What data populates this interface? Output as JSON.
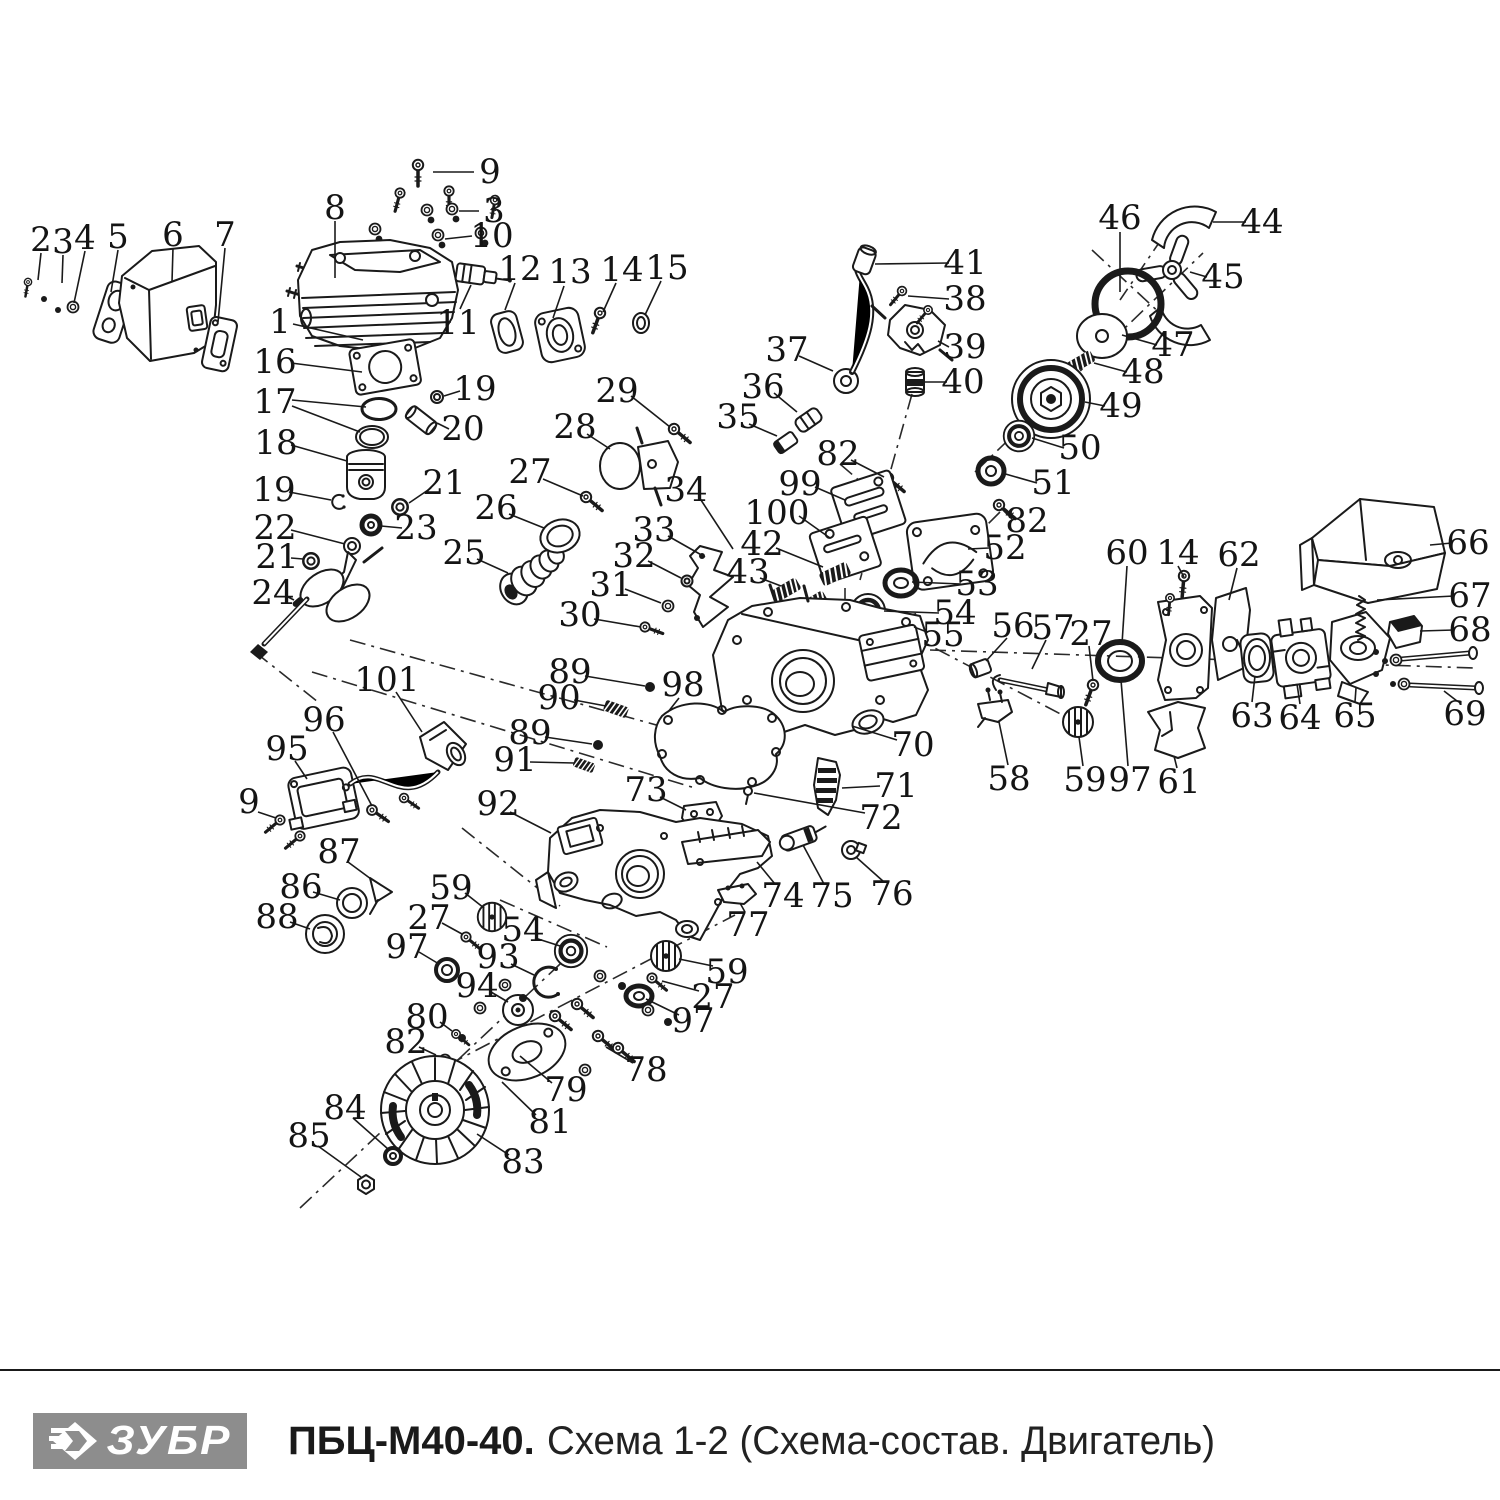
{
  "footer": {
    "brand": "ЗУБР",
    "model": "ПБЦ-М40-40.",
    "subtitle": "Схема 1-2 (Схема-состав. Двигатель)"
  },
  "colors": {
    "line": "#1a1a1a",
    "logo_bg": "#8d8d8d",
    "label": "#141414"
  },
  "labels": [
    {
      "n": "2",
      "x": 41,
      "y": 240,
      "lead": [
        [
          41,
          253,
          38,
          280
        ]
      ]
    },
    {
      "n": "3",
      "x": 63,
      "y": 242,
      "lead": [
        [
          63,
          255,
          62,
          283
        ]
      ]
    },
    {
      "n": "4",
      "x": 85,
      "y": 238,
      "lead": [
        [
          85,
          251,
          74,
          303
        ]
      ]
    },
    {
      "n": "5",
      "x": 118,
      "y": 237,
      "lead": [
        [
          118,
          250,
          111,
          292
        ]
      ]
    },
    {
      "n": "6",
      "x": 173,
      "y": 235,
      "lead": [
        [
          173,
          248,
          172,
          282
        ]
      ]
    },
    {
      "n": "7",
      "x": 225,
      "y": 235,
      "lead": [
        [
          225,
          248,
          218,
          322
        ]
      ]
    },
    {
      "n": "9",
      "x": 490,
      "y": 172,
      "lead": [
        [
          474,
          172,
          433,
          172
        ]
      ]
    },
    {
      "n": "8",
      "x": 335,
      "y": 208,
      "lead": [
        [
          335,
          221,
          335,
          278
        ]
      ]
    },
    {
      "n": "3",
      "x": 494,
      "y": 211,
      "lead": [
        [
          479,
          211,
          459,
          211
        ]
      ]
    },
    {
      "n": "10",
      "x": 492,
      "y": 236,
      "lead": [
        [
          472,
          236,
          445,
          239
        ]
      ]
    },
    {
      "n": "1",
      "x": 280,
      "y": 322,
      "lead": [
        [
          293,
          324,
          363,
          340
        ]
      ]
    },
    {
      "n": "11",
      "x": 458,
      "y": 323,
      "lead": [
        [
          460,
          309,
          471,
          285
        ]
      ]
    },
    {
      "n": "12",
      "x": 520,
      "y": 269,
      "lead": [
        [
          515,
          283,
          505,
          310
        ]
      ]
    },
    {
      "n": "13",
      "x": 570,
      "y": 272,
      "lead": [
        [
          564,
          286,
          553,
          318
        ]
      ]
    },
    {
      "n": "14",
      "x": 622,
      "y": 270,
      "lead": [
        [
          616,
          283,
          603,
          312
        ]
      ]
    },
    {
      "n": "15",
      "x": 667,
      "y": 268,
      "lead": [
        [
          661,
          281,
          645,
          315
        ]
      ]
    },
    {
      "n": "16",
      "x": 275,
      "y": 362,
      "lead": [
        [
          291,
          363,
          362,
          372
        ]
      ]
    },
    {
      "n": "17",
      "x": 275,
      "y": 402,
      "lead": [
        [
          292,
          400,
          366,
          407
        ],
        [
          292,
          406,
          360,
          432
        ]
      ]
    },
    {
      "n": "19",
      "x": 475,
      "y": 389,
      "lead": [
        [
          460,
          391,
          444,
          396
        ]
      ]
    },
    {
      "n": "20",
      "x": 463,
      "y": 429,
      "lead": [
        [
          449,
          429,
          437,
          423
        ]
      ]
    },
    {
      "n": "18",
      "x": 276,
      "y": 443,
      "lead": [
        [
          291,
          445,
          347,
          461
        ]
      ]
    },
    {
      "n": "21",
      "x": 444,
      "y": 483,
      "lead": [
        [
          431,
          488,
          409,
          503
        ]
      ]
    },
    {
      "n": "19",
      "x": 274,
      "y": 490,
      "lead": [
        [
          289,
          492,
          331,
          500
        ]
      ]
    },
    {
      "n": "22",
      "x": 275,
      "y": 528,
      "lead": [
        [
          291,
          530,
          345,
          544
        ]
      ]
    },
    {
      "n": "23",
      "x": 416,
      "y": 528,
      "lead": [
        [
          402,
          528,
          381,
          526
        ]
      ]
    },
    {
      "n": "21",
      "x": 277,
      "y": 557,
      "lead": [
        [
          291,
          558,
          303,
          559
        ]
      ]
    },
    {
      "n": "24",
      "x": 273,
      "y": 593,
      "lead": [
        [
          286,
          596,
          294,
          600
        ]
      ]
    },
    {
      "n": "26",
      "x": 496,
      "y": 508,
      "lead": [
        [
          509,
          514,
          544,
          528
        ]
      ]
    },
    {
      "n": "25",
      "x": 464,
      "y": 553,
      "lead": [
        [
          477,
          559,
          508,
          573
        ]
      ]
    },
    {
      "n": "27",
      "x": 530,
      "y": 472,
      "lead": [
        [
          543,
          479,
          583,
          496
        ]
      ]
    },
    {
      "n": "28",
      "x": 575,
      "y": 427,
      "lead": [
        [
          587,
          434,
          610,
          449
        ]
      ]
    },
    {
      "n": "29",
      "x": 617,
      "y": 391,
      "lead": [
        [
          631,
          396,
          670,
          427
        ]
      ]
    },
    {
      "n": "34",
      "x": 686,
      "y": 490,
      "lead": [
        [
          699,
          497,
          733,
          549
        ]
      ]
    },
    {
      "n": "33",
      "x": 654,
      "y": 530,
      "lead": [
        [
          668,
          536,
          705,
          557
        ]
      ]
    },
    {
      "n": "32",
      "x": 634,
      "y": 556,
      "lead": [
        [
          648,
          561,
          681,
          578
        ]
      ]
    },
    {
      "n": "31",
      "x": 611,
      "y": 585,
      "lead": [
        [
          625,
          589,
          661,
          603
        ]
      ]
    },
    {
      "n": "30",
      "x": 580,
      "y": 615,
      "lead": [
        [
          594,
          619,
          641,
          627
        ]
      ]
    },
    {
      "n": "35",
      "x": 738,
      "y": 417,
      "lead": [
        [
          749,
          424,
          777,
          436
        ]
      ]
    },
    {
      "n": "36",
      "x": 763,
      "y": 387,
      "lead": [
        [
          774,
          393,
          797,
          412
        ]
      ]
    },
    {
      "n": "37",
      "x": 787,
      "y": 350,
      "lead": [
        [
          799,
          356,
          833,
          371
        ]
      ]
    },
    {
      "n": "41",
      "x": 965,
      "y": 263,
      "lead": [
        [
          949,
          263,
          875,
          264
        ]
      ]
    },
    {
      "n": "38",
      "x": 965,
      "y": 299,
      "lead": [
        [
          949,
          299,
          908,
          296
        ]
      ]
    },
    {
      "n": "39",
      "x": 965,
      "y": 347,
      "lead": [
        [
          949,
          347,
          938,
          341
        ]
      ]
    },
    {
      "n": "40",
      "x": 963,
      "y": 382,
      "lead": [
        [
          947,
          382,
          925,
          382
        ]
      ]
    },
    {
      "n": "46",
      "x": 1120,
      "y": 218,
      "lead": [
        [
          1120,
          232,
          1120,
          292
        ]
      ]
    },
    {
      "n": "44",
      "x": 1262,
      "y": 222,
      "lead": [
        [
          1246,
          222,
          1213,
          222
        ]
      ]
    },
    {
      "n": "45",
      "x": 1223,
      "y": 277,
      "lead": [
        [
          1207,
          277,
          1190,
          272
        ]
      ]
    },
    {
      "n": "47",
      "x": 1173,
      "y": 345,
      "lead": [
        [
          1157,
          345,
          1122,
          335
        ]
      ]
    },
    {
      "n": "48",
      "x": 1143,
      "y": 372,
      "lead": [
        [
          1127,
          372,
          1094,
          363
        ]
      ]
    },
    {
      "n": "49",
      "x": 1121,
      "y": 406,
      "lead": [
        [
          1105,
          406,
          1085,
          402
        ]
      ]
    },
    {
      "n": "50",
      "x": 1080,
      "y": 448,
      "lead": [
        [
          1064,
          448,
          1032,
          438
        ]
      ]
    },
    {
      "n": "51",
      "x": 1053,
      "y": 483,
      "lead": [
        [
          1037,
          483,
          1002,
          473
        ]
      ]
    },
    {
      "n": "82",
      "x": 838,
      "y": 454,
      "lead": [
        [
          851,
          460,
          884,
          477
        ]
      ]
    },
    {
      "n": "82",
      "x": 1027,
      "y": 521,
      "lead": [
        [
          1012,
          519,
          1001,
          508
        ]
      ]
    },
    {
      "n": "99",
      "x": 800,
      "y": 484,
      "lead": [
        [
          815,
          487,
          845,
          500
        ]
      ]
    },
    {
      "n": "100",
      "x": 777,
      "y": 513,
      "lead": [
        [
          799,
          516,
          830,
          538
        ]
      ]
    },
    {
      "n": "42",
      "x": 762,
      "y": 544,
      "lead": [
        [
          776,
          548,
          823,
          567
        ]
      ]
    },
    {
      "n": "43",
      "x": 748,
      "y": 572,
      "lead": [
        [
          760,
          578,
          781,
          586
        ]
      ]
    },
    {
      "n": "52",
      "x": 1005,
      "y": 548,
      "lead": [
        [
          989,
          548,
          968,
          549
        ]
      ]
    },
    {
      "n": "53",
      "x": 977,
      "y": 584,
      "lead": [
        [
          961,
          584,
          912,
          582
        ]
      ]
    },
    {
      "n": "54",
      "x": 955,
      "y": 613,
      "lead": [
        [
          939,
          613,
          884,
          611
        ]
      ]
    },
    {
      "n": "55",
      "x": 943,
      "y": 635,
      "lead": [
        [
          927,
          632,
          914,
          627
        ]
      ]
    },
    {
      "n": "56",
      "x": 1013,
      "y": 626,
      "lead": [
        [
          1007,
          638,
          986,
          661
        ]
      ]
    },
    {
      "n": "57",
      "x": 1053,
      "y": 628,
      "lead": [
        [
          1046,
          640,
          1032,
          669
        ]
      ]
    },
    {
      "n": "27",
      "x": 1091,
      "y": 634,
      "lead": [
        [
          1089,
          646,
          1093,
          681
        ]
      ]
    },
    {
      "n": "60",
      "x": 1127,
      "y": 553,
      "lead": [
        [
          1127,
          566,
          1122,
          644
        ]
      ]
    },
    {
      "n": "14",
      "x": 1178,
      "y": 553,
      "lead": [
        [
          1178,
          566,
          1184,
          577
        ]
      ]
    },
    {
      "n": "62",
      "x": 1239,
      "y": 555,
      "lead": [
        [
          1237,
          568,
          1229,
          600
        ]
      ]
    },
    {
      "n": "66",
      "x": 1468,
      "y": 543,
      "lead": [
        [
          1452,
          543,
          1430,
          545
        ]
      ]
    },
    {
      "n": "67",
      "x": 1470,
      "y": 596,
      "lead": [
        [
          1454,
          596,
          1377,
          600
        ]
      ]
    },
    {
      "n": "68",
      "x": 1470,
      "y": 630,
      "lead": [
        [
          1454,
          630,
          1420,
          631
        ]
      ]
    },
    {
      "n": "63",
      "x": 1252,
      "y": 716,
      "lead": [
        [
          1252,
          702,
          1255,
          676
        ]
      ]
    },
    {
      "n": "64",
      "x": 1300,
      "y": 718,
      "lead": [
        [
          1300,
          704,
          1297,
          684
        ]
      ]
    },
    {
      "n": "65",
      "x": 1355,
      "y": 716,
      "lead": [
        [
          1355,
          702,
          1356,
          688
        ]
      ]
    },
    {
      "n": "69",
      "x": 1465,
      "y": 714,
      "lead": [
        [
          1457,
          701,
          1444,
          691
        ]
      ]
    },
    {
      "n": "58",
      "x": 1009,
      "y": 779,
      "lead": [
        [
          1008,
          765,
          999,
          722
        ]
      ]
    },
    {
      "n": "59",
      "x": 1085,
      "y": 780,
      "lead": [
        [
          1083,
          766,
          1079,
          737
        ]
      ]
    },
    {
      "n": "97",
      "x": 1130,
      "y": 780,
      "lead": [
        [
          1128,
          766,
          1121,
          680
        ]
      ]
    },
    {
      "n": "61",
      "x": 1179,
      "y": 782,
      "lead": [
        [
          1177,
          768,
          1174,
          756
        ]
      ]
    },
    {
      "n": "101",
      "x": 387,
      "y": 680,
      "lead": [
        [
          396,
          692,
          422,
          732
        ]
      ]
    },
    {
      "n": "96",
      "x": 324,
      "y": 720,
      "lead": [
        [
          333,
          732,
          372,
          806
        ]
      ]
    },
    {
      "n": "95",
      "x": 287,
      "y": 749,
      "lead": [
        [
          295,
          761,
          307,
          779
        ]
      ]
    },
    {
      "n": "9",
      "x": 249,
      "y": 802,
      "lead": [
        [
          258,
          812,
          276,
          818
        ]
      ]
    },
    {
      "n": "87",
      "x": 339,
      "y": 852,
      "lead": [
        [
          348,
          862,
          371,
          879
        ]
      ]
    },
    {
      "n": "86",
      "x": 301,
      "y": 887,
      "lead": [
        [
          313,
          892,
          340,
          900
        ]
      ]
    },
    {
      "n": "88",
      "x": 277,
      "y": 917,
      "lead": [
        [
          290,
          922,
          310,
          929
        ]
      ]
    },
    {
      "n": "89",
      "x": 570,
      "y": 672,
      "lead": [
        [
          585,
          676,
          645,
          686
        ]
      ]
    },
    {
      "n": "90",
      "x": 559,
      "y": 698,
      "lead": [
        [
          574,
          700,
          606,
          706
        ]
      ]
    },
    {
      "n": "89",
      "x": 530,
      "y": 733,
      "lead": [
        [
          545,
          737,
          592,
          744
        ]
      ]
    },
    {
      "n": "91",
      "x": 515,
      "y": 760,
      "lead": [
        [
          530,
          762,
          574,
          763
        ]
      ]
    },
    {
      "n": "98",
      "x": 683,
      "y": 685,
      "lead": [
        [
          679,
          698,
          668,
          712
        ]
      ]
    },
    {
      "n": "73",
      "x": 646,
      "y": 790,
      "lead": [
        [
          660,
          797,
          686,
          810
        ]
      ]
    },
    {
      "n": "70",
      "x": 913,
      "y": 745,
      "lead": [
        [
          897,
          740,
          852,
          726
        ]
      ]
    },
    {
      "n": "71",
      "x": 896,
      "y": 786,
      "lead": [
        [
          880,
          786,
          842,
          788
        ]
      ]
    },
    {
      "n": "72",
      "x": 881,
      "y": 818,
      "lead": [
        [
          865,
          813,
          754,
          793
        ]
      ]
    },
    {
      "n": "92",
      "x": 498,
      "y": 804,
      "lead": [
        [
          510,
          812,
          551,
          833
        ]
      ]
    },
    {
      "n": "59",
      "x": 451,
      "y": 888,
      "lead": [
        [
          465,
          893,
          484,
          908
        ]
      ]
    },
    {
      "n": "27",
      "x": 429,
      "y": 918,
      "lead": [
        [
          442,
          923,
          462,
          934
        ]
      ]
    },
    {
      "n": "97",
      "x": 407,
      "y": 947,
      "lead": [
        [
          419,
          952,
          439,
          964
        ]
      ]
    },
    {
      "n": "54",
      "x": 523,
      "y": 930,
      "lead": [
        [
          535,
          938,
          560,
          946
        ]
      ]
    },
    {
      "n": "93",
      "x": 498,
      "y": 957,
      "lead": [
        [
          511,
          964,
          534,
          975
        ]
      ]
    },
    {
      "n": "94",
      "x": 477,
      "y": 986,
      "lead": [
        [
          491,
          992,
          508,
          1002
        ]
      ]
    },
    {
      "n": "80",
      "x": 427,
      "y": 1017,
      "lead": [
        [
          440,
          1022,
          452,
          1031
        ]
      ]
    },
    {
      "n": "82",
      "x": 406,
      "y": 1042,
      "lead": [
        [
          419,
          1047,
          436,
          1055
        ]
      ]
    },
    {
      "n": "79",
      "x": 566,
      "y": 1090,
      "lead": [
        [
          552,
          1083,
          520,
          1056
        ]
      ]
    },
    {
      "n": "81",
      "x": 550,
      "y": 1122,
      "lead": [
        [
          536,
          1115,
          502,
          1082
        ]
      ]
    },
    {
      "n": "83",
      "x": 523,
      "y": 1162,
      "lead": [
        [
          509,
          1155,
          477,
          1134
        ]
      ]
    },
    {
      "n": "78",
      "x": 646,
      "y": 1070,
      "lead": [
        [
          633,
          1063,
          606,
          1047
        ]
      ]
    },
    {
      "n": "97",
      "x": 693,
      "y": 1021,
      "lead": [
        [
          679,
          1015,
          646,
          999
        ]
      ]
    },
    {
      "n": "27",
      "x": 713,
      "y": 997,
      "lead": [
        [
          699,
          991,
          662,
          981
        ]
      ]
    },
    {
      "n": "59",
      "x": 727,
      "y": 972,
      "lead": [
        [
          713,
          966,
          679,
          959
        ]
      ]
    },
    {
      "n": "74",
      "x": 783,
      "y": 896,
      "lead": [
        [
          775,
          884,
          757,
          862
        ]
      ]
    },
    {
      "n": "75",
      "x": 832,
      "y": 896,
      "lead": [
        [
          824,
          884,
          803,
          845
        ]
      ]
    },
    {
      "n": "76",
      "x": 892,
      "y": 894,
      "lead": [
        [
          884,
          882,
          856,
          857
        ]
      ]
    },
    {
      "n": "77",
      "x": 748,
      "y": 925,
      "lead": [
        [
          745,
          912,
          740,
          903
        ]
      ]
    },
    {
      "n": "84",
      "x": 345,
      "y": 1108,
      "lead": [
        [
          353,
          1118,
          388,
          1149
        ]
      ]
    },
    {
      "n": "85",
      "x": 309,
      "y": 1136,
      "lead": [
        [
          318,
          1146,
          361,
          1177
        ]
      ]
    }
  ]
}
